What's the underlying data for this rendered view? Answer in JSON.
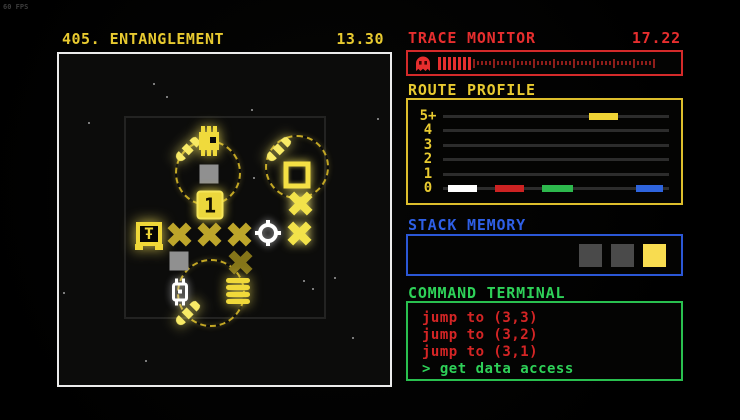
{
  "fps_label": "60 FPS",
  "header": {
    "title": "405. ENTANGLEMENT",
    "timer": "13.30"
  },
  "trace_monitor": {
    "title": "TRACE MONITOR",
    "value": "17.22",
    "icon": "ghost-icon",
    "bright_bars": 7,
    "dim_ticks": 46,
    "accent_color": "#e62e2e"
  },
  "route_profile": {
    "title": "ROUTE PROFILE",
    "accent_color": "#e8ca30",
    "chart_data": {
      "type": "step-timeline",
      "y_labels": [
        "5+",
        "4",
        "3",
        "2",
        "1",
        "0"
      ],
      "x_range": [
        0,
        1
      ],
      "grid": "horizontal-lines",
      "segments": [
        {
          "row": "5+",
          "color": "#f0d435",
          "start": 0.645,
          "end": 0.775
        },
        {
          "row": "0",
          "color": "#ffffff",
          "start": 0.02,
          "end": 0.15
        },
        {
          "row": "0",
          "color": "#cc2222",
          "start": 0.23,
          "end": 0.36
        },
        {
          "row": "0",
          "color": "#2db84d",
          "start": 0.44,
          "end": 0.575
        },
        {
          "row": "0",
          "color": "#2e64dd",
          "start": 0.855,
          "end": 0.975
        }
      ]
    }
  },
  "stack_memory": {
    "title": "STACK MEMORY",
    "accent_color": "#2e5fe6",
    "slots": [
      {
        "color": "#4a4a4a",
        "state": "empty"
      },
      {
        "color": "#4a4a4a",
        "state": "empty"
      },
      {
        "color": "#f8dc50",
        "state": "filled"
      }
    ]
  },
  "command_terminal": {
    "title": "COMMAND TERMINAL",
    "accent_color": "#2ed158",
    "lines": [
      {
        "text": "jump to (3,3)",
        "type": "command"
      },
      {
        "text": "jump to (3,2)",
        "type": "command"
      },
      {
        "text": "jump to (3,1)",
        "type": "command"
      },
      {
        "text": "> get data access",
        "type": "prompt"
      }
    ]
  },
  "board": {
    "stars": [
      [
        94,
        29
      ],
      [
        107,
        42
      ],
      [
        192,
        55
      ],
      [
        318,
        64
      ],
      [
        29,
        68
      ],
      [
        194,
        123
      ],
      [
        4,
        238
      ],
      [
        244,
        226
      ],
      [
        253,
        234
      ],
      [
        275,
        223
      ],
      [
        293,
        283
      ],
      [
        86,
        306
      ]
    ],
    "pieces": [
      {
        "type": "orbit",
        "x": 149,
        "y": 119,
        "size": 66,
        "interactable": false
      },
      {
        "type": "orbit",
        "x": 238,
        "y": 113,
        "size": 64,
        "interactable": false
      },
      {
        "type": "orbit",
        "x": 152,
        "y": 239,
        "size": 68,
        "interactable": false
      },
      {
        "type": "comet",
        "x": 129,
        "y": 95,
        "interactable": false
      },
      {
        "type": "comet",
        "x": 220,
        "y": 95,
        "interactable": false
      },
      {
        "type": "comet",
        "x": 129,
        "y": 259,
        "interactable": false
      },
      {
        "type": "chip-rook",
        "x": 150,
        "y": 87,
        "interactable": true
      },
      {
        "type": "gray-square",
        "x": 150,
        "y": 120,
        "interactable": true
      },
      {
        "type": "one-chip",
        "x": 151,
        "y": 151,
        "label": "1",
        "interactable": true
      },
      {
        "type": "hollow-square",
        "x": 238,
        "y": 121,
        "interactable": true
      },
      {
        "type": "x-bright",
        "x": 241,
        "y": 149,
        "interactable": true
      },
      {
        "type": "player",
        "x": 90,
        "y": 180,
        "glyph": "Ŧ",
        "interactable": true
      },
      {
        "type": "x-mid",
        "x": 120,
        "y": 180,
        "interactable": true
      },
      {
        "type": "x-mid",
        "x": 150,
        "y": 180,
        "interactable": true
      },
      {
        "type": "x-mid",
        "x": 180,
        "y": 180,
        "interactable": true
      },
      {
        "type": "target-ring",
        "x": 209,
        "y": 179,
        "interactable": true
      },
      {
        "type": "x-bright",
        "x": 240,
        "y": 179,
        "interactable": true
      },
      {
        "type": "gray-square",
        "x": 120,
        "y": 207,
        "interactable": true
      },
      {
        "type": "x-dim",
        "x": 181,
        "y": 208,
        "interactable": true
      },
      {
        "type": "chip-white",
        "x": 121,
        "y": 238,
        "interactable": true
      },
      {
        "type": "coin-stack",
        "x": 179,
        "y": 238,
        "interactable": true
      }
    ]
  }
}
